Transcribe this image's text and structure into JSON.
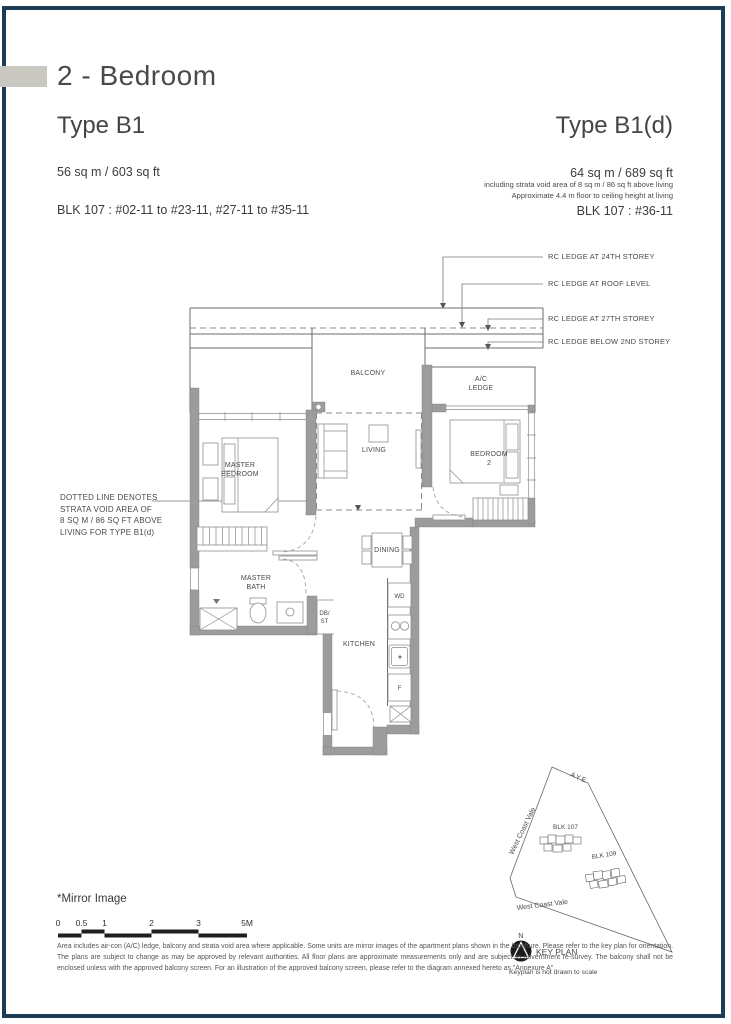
{
  "page": {
    "title": "2 - Bedroom"
  },
  "left_unit": {
    "type": "Type B1",
    "area": "56 sq m / 603 sq ft",
    "blocks": "BLK 107 : #02-11 to #23-11, #27-11 to #35-11"
  },
  "right_unit": {
    "type": "Type B1(d)",
    "area": "64 sq m / 689 sq ft",
    "note1": "including strata void area of 8 sq m / 86 sq ft above living",
    "note2": "Approximate 4.4 m floor to ceiling height at living",
    "blocks": "BLK 107 : #36-11"
  },
  "floor_plan": {
    "rooms": {
      "balcony": "BALCONY",
      "ac_l1": "A/C",
      "ac_l2": "LEDGE",
      "mb_l1": "MASTER",
      "mb_l2": "BEDROOM",
      "living": "LIVING",
      "b2_l1": "BEDROOM",
      "b2_l2": "2",
      "dining": "DINING",
      "bath_l1": "MASTER",
      "bath_l2": "BATH",
      "db_l1": "DB/",
      "db_l2": "ST",
      "kitchen": "KITCHEN",
      "wd": "WD",
      "fridge": "F"
    },
    "annotations": {
      "strata_note": "DOTTED LINE DENOTES\nSTRATA VOID AREA OF\n8 SQ M / 86 SQ FT ABOVE\nLIVING FOR TYPE B1(d)",
      "rc_24": "RC LEDGE AT 24TH STOREY",
      "rc_roof": "RC LEDGE AT ROOF LEVEL",
      "rc_27": "RC LEDGE AT 27TH STOREY",
      "rc_2nd": "RC LEDGE BELOW 2ND STOREY"
    }
  },
  "key_plan": {
    "aye": "AYE",
    "wcv_left": "West Coast Vale",
    "wcv_bottom": "West Coast Vale",
    "blk_107": "BLK 107",
    "blk_109": "BLK 109",
    "north": "N",
    "label": "KEY PLAN",
    "note": "Keyplan is not drawn to scale"
  },
  "footer": {
    "mirror": "*Mirror Image",
    "scale_ticks": [
      "0",
      "0.5",
      "1",
      "2",
      "3",
      "5M"
    ],
    "disclaimer": "Area includes air-con (A/C) ledge, balcony and strata void area where applicable. Some units are mirror images of the apartment plans shown in the brochure. Please refer to the key plan for orientation. The plans are subject to change as may be approved by relevant authorities. All floor plans are approximate measurements only and are subject to government re-survey. The balcony shall not be enclosed unless with the approved balcony screen. For an illustration of the approved balcony screen, please refer to the diagram annexed hereto as \"Annexure A\"."
  }
}
